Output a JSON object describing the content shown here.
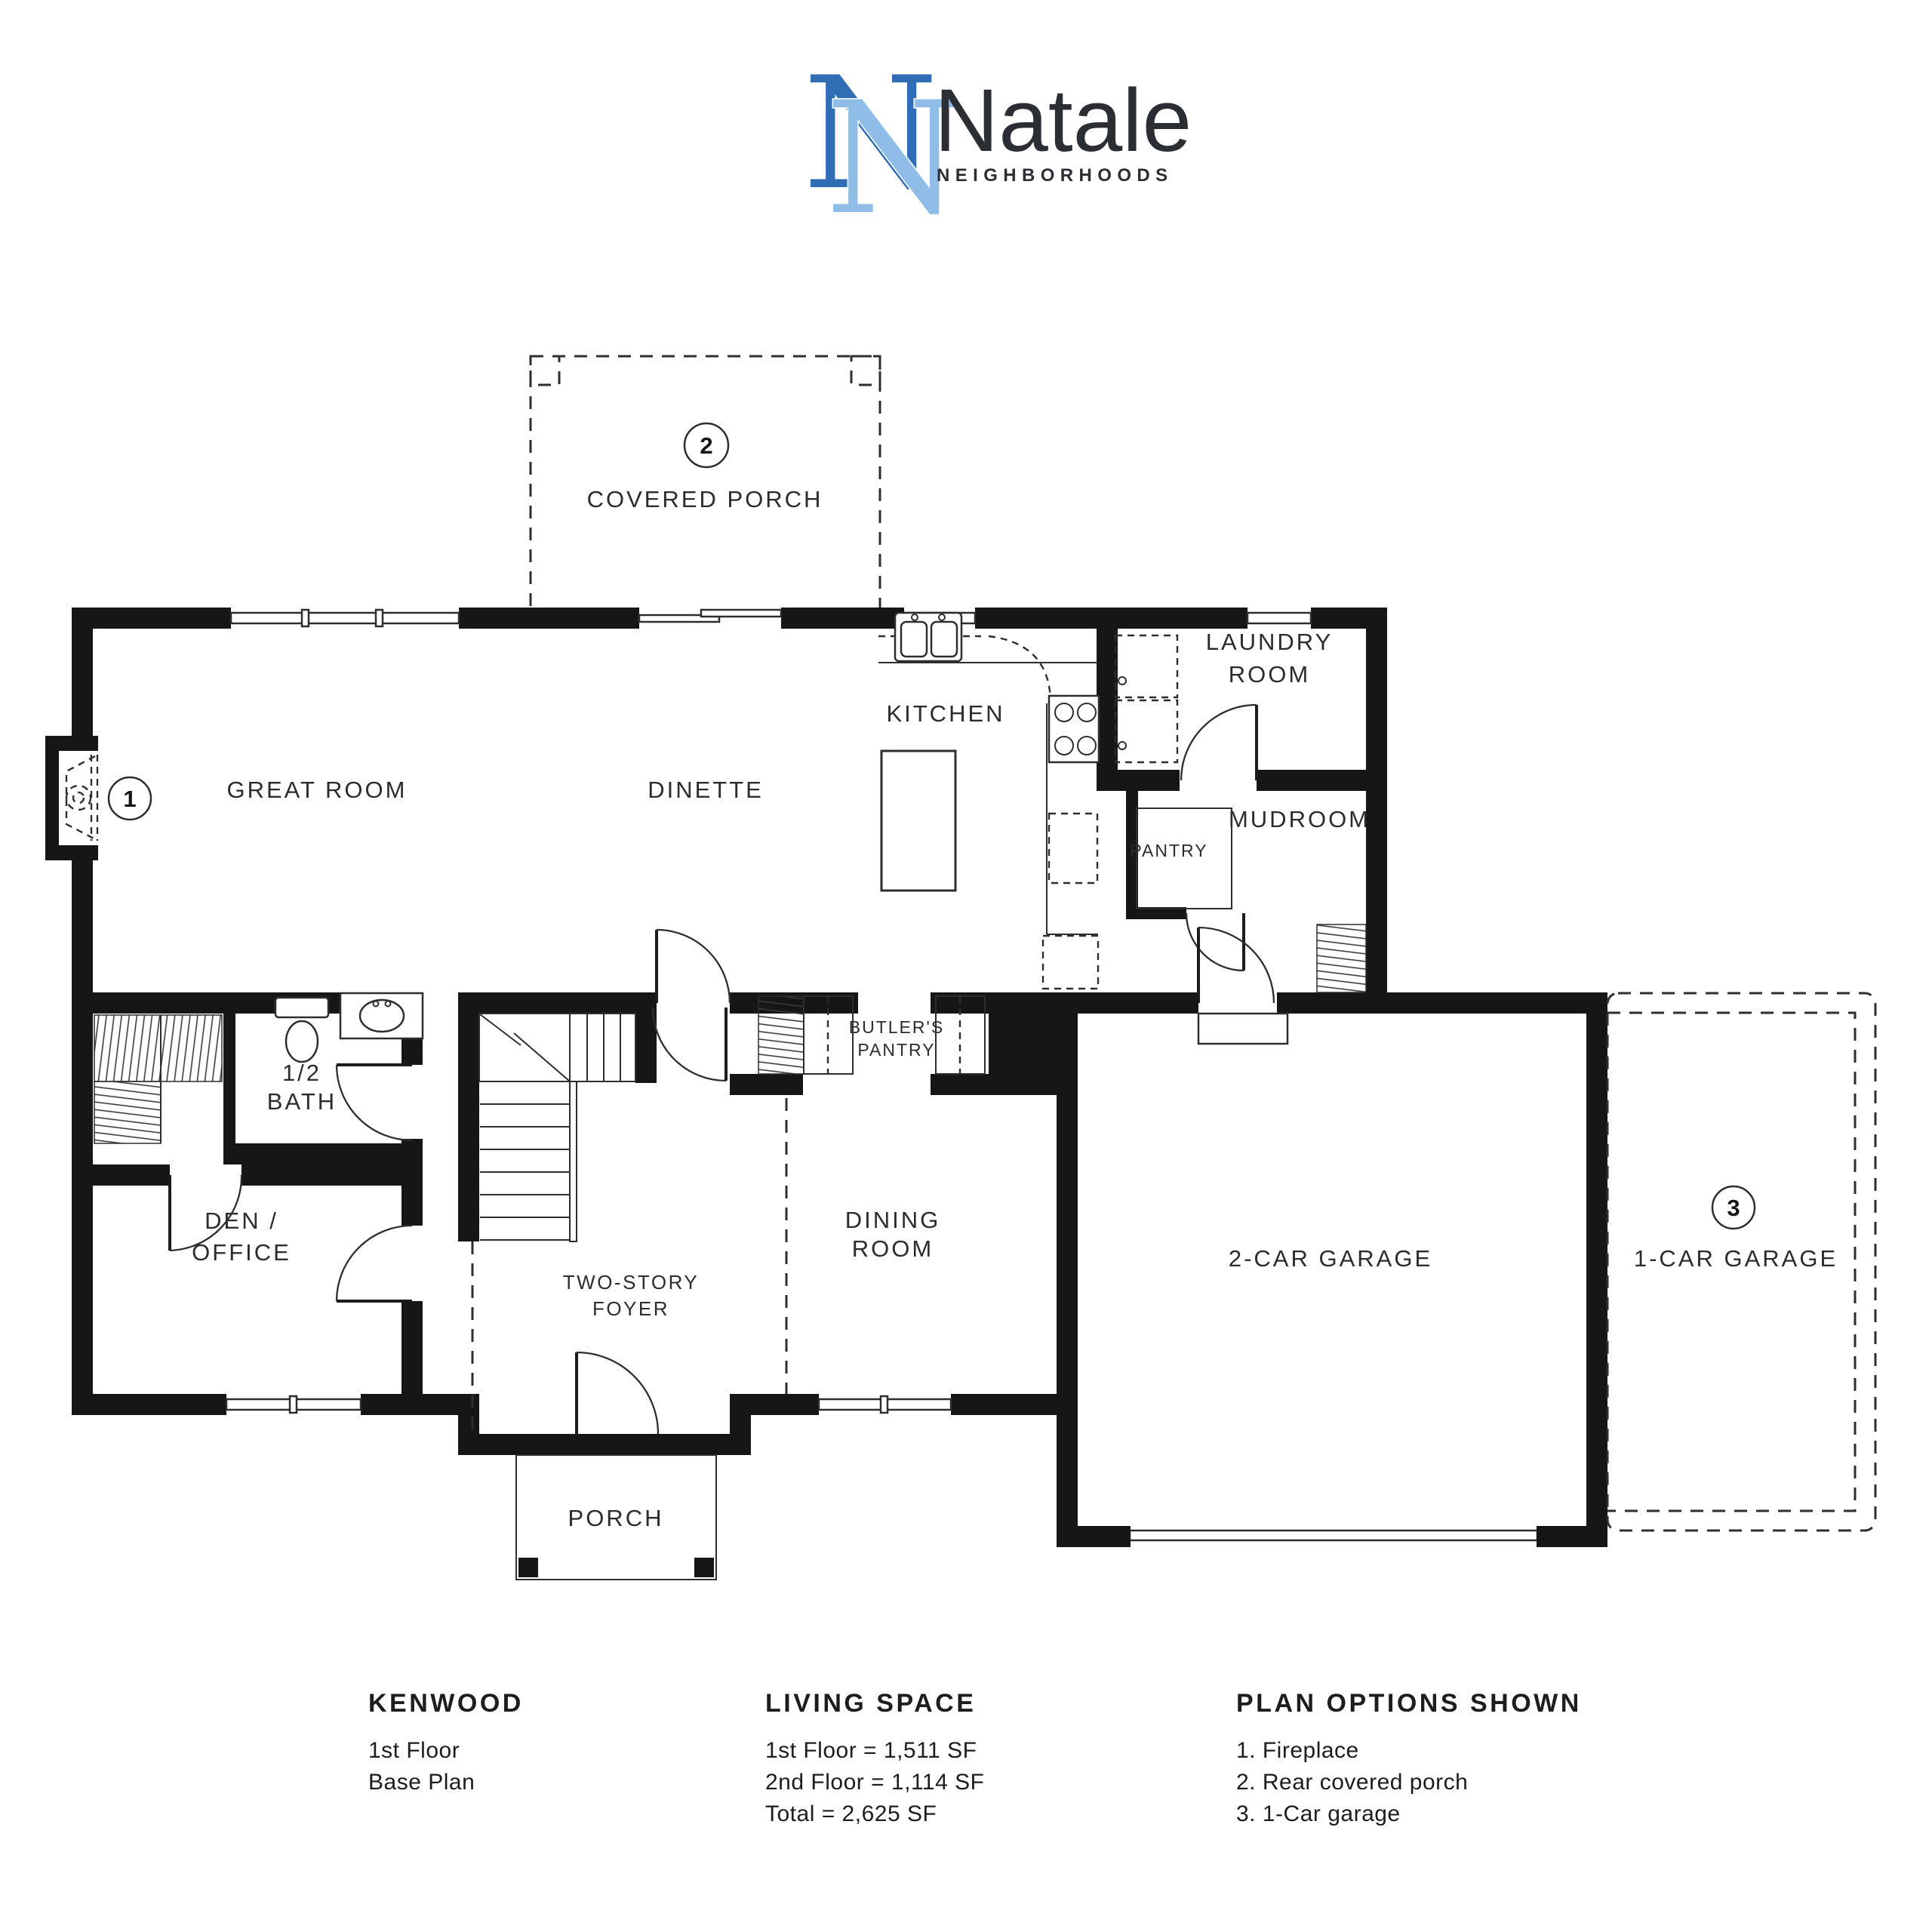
{
  "logo": {
    "monogram": "N",
    "brand": "Natale",
    "tagline": "NEIGHBORHOODS",
    "colors": {
      "dark_blue": "#2f6eb4",
      "light_blue": "#90bde8",
      "text": "#2b2e33"
    }
  },
  "plan": {
    "rooms": {
      "covered_porch": "COVERED PORCH",
      "great_room": "GREAT ROOM",
      "dinette": "DINETTE",
      "kitchen": "KITCHEN",
      "laundry_line1": "LAUNDRY",
      "laundry_line2": "ROOM",
      "mudroom": "MUDROOM",
      "pantry": "PANTRY",
      "butlers_line1": "BUTLER'S",
      "butlers_line2": "PANTRY",
      "half_bath_line1": "1/2",
      "half_bath_line2": "BATH",
      "den_line1": "DEN /",
      "den_line2": "OFFICE",
      "foyer_line1": "TWO-STORY",
      "foyer_line2": "FOYER",
      "dining_line1": "DINING",
      "dining_line2": "ROOM",
      "porch": "PORCH",
      "two_car_garage": "2-CAR GARAGE",
      "one_car_garage": "1-CAR GARAGE"
    },
    "markers": {
      "fireplace": "1",
      "rear_covered_porch": "2",
      "one_car_garage": "3"
    }
  },
  "legend": {
    "plan_name": {
      "title": "KENWOOD",
      "line1": "1st Floor",
      "line2": "Base Plan"
    },
    "living_space": {
      "title": "LIVING SPACE",
      "line1": "1st Floor = 1,511 SF",
      "line2": "2nd Floor = 1,114 SF",
      "line3": "Total = 2,625 SF"
    },
    "plan_options": {
      "title": "PLAN OPTIONS SHOWN",
      "line1": "1. Fireplace",
      "line2": "2. Rear covered porch",
      "line3": "3. 1-Car garage"
    }
  }
}
